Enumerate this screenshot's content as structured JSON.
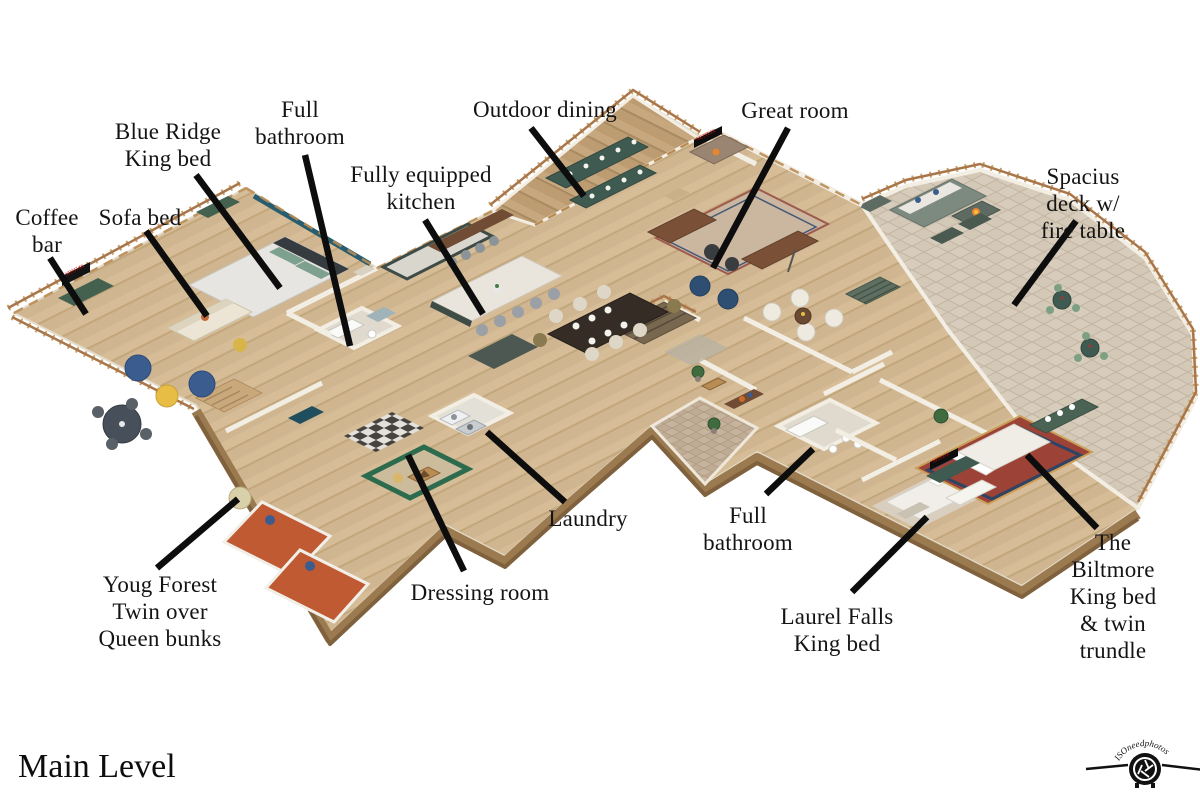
{
  "page": {
    "background": "#ffffff",
    "title": "Main Level"
  },
  "branding": {
    "watermark_text": "ISOneedphotos"
  },
  "media": {
    "tv_brand": "NETFLIX"
  },
  "colors": {
    "label_text": "#141414",
    "leader_line": "#0d0d0d",
    "wood_floor": "#d6bd97",
    "deck_wood": "#c7a87e",
    "pavers": "#d7ccbc",
    "wall": "#f3eee3",
    "teal_accent": "#275d6e",
    "railing": "#a8764a",
    "netflix_red": "#e50914",
    "bunk_orange": "#c05a33",
    "cabinet_green": "#44604e"
  },
  "floorplan": {
    "name": "Main Level floor plan",
    "labels": [
      {
        "id": "coffee-bar",
        "lines": [
          "Coffee",
          "bar"
        ],
        "cx": 47,
        "top": 204,
        "leader": [
          50,
          258,
          86,
          314
        ]
      },
      {
        "id": "sofa-bed",
        "lines": [
          "Sofa bed"
        ],
        "cx": 140,
        "top": 204,
        "leader": [
          146,
          231,
          207,
          316
        ]
      },
      {
        "id": "blue-ridge",
        "lines": [
          "Blue Ridge",
          "King bed"
        ],
        "cx": 168,
        "top": 118,
        "leader": [
          196,
          175,
          280,
          288
        ]
      },
      {
        "id": "full-bathroom-upper",
        "lines": [
          "Full",
          "bathroom"
        ],
        "cx": 300,
        "top": 96,
        "leader": [
          305,
          155,
          350,
          346
        ]
      },
      {
        "id": "kitchen",
        "lines": [
          "Fully equipped",
          "kitchen"
        ],
        "cx": 421,
        "top": 161,
        "leader": [
          425,
          220,
          483,
          314
        ]
      },
      {
        "id": "outdoor-dining",
        "lines": [
          "Outdoor dining"
        ],
        "cx": 545,
        "top": 96,
        "leader": [
          531,
          128,
          584,
          196
        ]
      },
      {
        "id": "great-room",
        "lines": [
          "Great room"
        ],
        "cx": 795,
        "top": 97,
        "leader": [
          788,
          128,
          713,
          268
        ]
      },
      {
        "id": "deck",
        "lines": [
          "Spacius deck w/",
          "fire table"
        ],
        "cx": 1083,
        "top": 163,
        "leader": [
          1076,
          221,
          1014,
          305
        ]
      },
      {
        "id": "laundry",
        "lines": [
          "Laundry"
        ],
        "cx": 588,
        "top": 505,
        "leader": [
          565,
          502,
          487,
          432
        ]
      },
      {
        "id": "full-bathroom-lower",
        "lines": [
          "Full",
          "bathroom"
        ],
        "cx": 748,
        "top": 502,
        "leader": [
          766,
          494,
          813,
          449
        ]
      },
      {
        "id": "laurel-falls",
        "lines": [
          "Laurel Falls",
          "King bed"
        ],
        "cx": 837,
        "top": 603,
        "leader": [
          852,
          592,
          927,
          517
        ]
      },
      {
        "id": "biltmore",
        "lines": [
          "The Biltmore",
          "King bed",
          "& twin trundle"
        ],
        "cx": 1113,
        "top": 529,
        "leader": [
          1097,
          528,
          1027,
          455
        ]
      },
      {
        "id": "young-forest",
        "lines": [
          "Youg Forest",
          "Twin over",
          "Queen bunks"
        ],
        "cx": 160,
        "top": 571,
        "leader": [
          157,
          568,
          238,
          499
        ]
      },
      {
        "id": "dressing-room",
        "lines": [
          "Dressing room"
        ],
        "cx": 480,
        "top": 579,
        "leader": [
          464,
          571,
          408,
          455
        ]
      }
    ]
  }
}
